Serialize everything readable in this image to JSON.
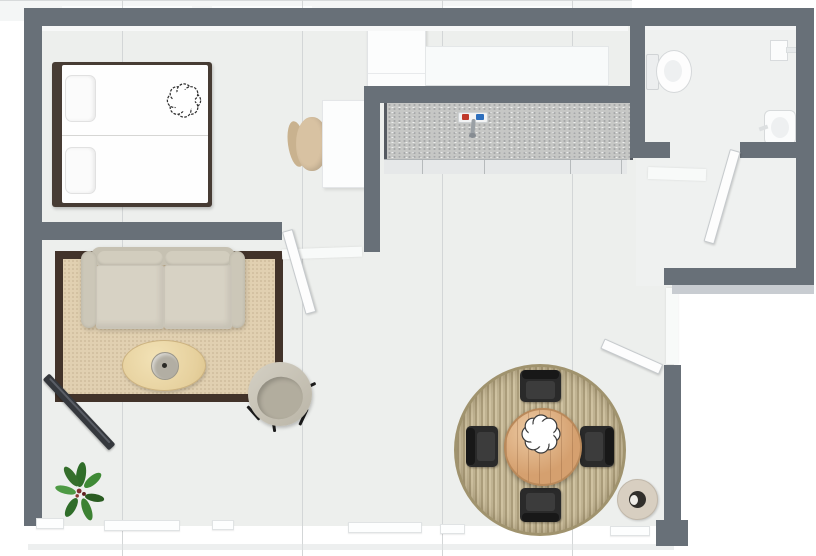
{
  "scene": {
    "type": "floor-plan-3d-top-view",
    "visible_text": "none",
    "background": "#ffffff",
    "floor_color": "#edefed",
    "wall_color": "#687078"
  },
  "palette": {
    "wall": "#687078",
    "wall_face_light": "#c8ccd1",
    "floor": "#edefed",
    "exterior": "#ffffff",
    "rug_living_border": "#42332a",
    "rug_living": "#e1d0b1",
    "sofa": "#d7d2c4",
    "coffee_table": "#e6d09d",
    "tv": "#35383d",
    "egg_chair": "#c4bfb1",
    "bed_frame": "#473c34",
    "bed_linen": "#fefefe",
    "kitchen_counter": "#c6c7c5",
    "cabinet_front": "#e6e8e9",
    "dining_table": "#d5a06f",
    "dining_rug": "#c0b392",
    "chair_black": "#2a2a2a",
    "plant_green": "#3f8a36",
    "plant_center": "#7e2f2f",
    "faucet_hot": "#c0392b",
    "faucet_cold": "#2e6fbd",
    "fixture_white": "#fbfcfc",
    "door_white": "#fdfdfd",
    "pot_dark": "#312f2b"
  },
  "rooms": {
    "bedroom": {
      "label": "Bedroom area with double bed and desk"
    },
    "kitchen": {
      "label": "Kitchen with counter and sink"
    },
    "bathroom": {
      "label": "Bathroom with toilet, shower and basin"
    },
    "hall": {
      "label": "Entry hallway"
    },
    "living": {
      "label": "Living area with sofa and TV"
    },
    "dining": {
      "label": "Dining area with round table"
    }
  },
  "furniture": {
    "bed": {
      "label": "Double bed with two pillows"
    },
    "bed_decor": {
      "label": "Flower-shaped cushion"
    },
    "desk": {
      "label": "Desk"
    },
    "desk_chair": {
      "label": "Desk chair"
    },
    "fridge": {
      "label": "Refrigerator"
    },
    "nook_cabinet": {
      "label": "Wall cabinet"
    },
    "counter": {
      "label": "Kitchen counter"
    },
    "faucet": {
      "label": "Sink faucet with hot and cold taps"
    },
    "toilet": {
      "label": "Toilet"
    },
    "shower": {
      "label": "Shower fixture"
    },
    "basin": {
      "label": "Wash basin"
    },
    "sofa": {
      "label": "Two-seat sofa"
    },
    "coffee_table": {
      "label": "Oval coffee table with bowl"
    },
    "tv": {
      "label": "Flat-screen TV"
    },
    "egg_chair": {
      "label": "Round lounge chair"
    },
    "plant": {
      "label": "Green plant"
    },
    "dining_table": {
      "label": "Round wooden dining table"
    },
    "dining_chair": {
      "label": "Black dining chair"
    },
    "dining_rug": {
      "label": "Round woven rug"
    },
    "living_rug": {
      "label": "Bordered area rug"
    },
    "centerpiece": {
      "label": "Flower centerpiece"
    },
    "floor_pot": {
      "label": "Floor planter"
    },
    "bedroom_door": {
      "label": "Bedroom door (open)"
    },
    "bathroom_door": {
      "label": "Bathroom door (open)"
    },
    "entry_door": {
      "label": "Entry door (open)"
    },
    "window_wall": {
      "label": "Window wall"
    }
  }
}
